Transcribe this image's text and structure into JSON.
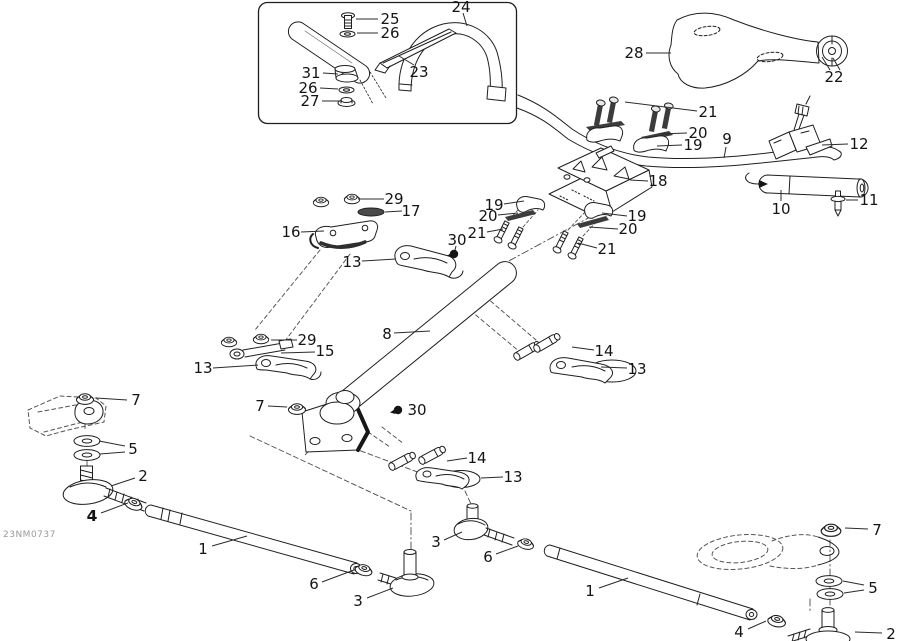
{
  "figure": {
    "code": "23NM0737"
  },
  "colors": {
    "line": "#1f1f1f",
    "dark_fill": "#3c3c3c",
    "leader": "#2b2b2b",
    "code_text": "#9a9a9a"
  },
  "labels": [
    {
      "text": "25",
      "x": 390,
      "y": 19,
      "lines": [
        [
          378,
          19,
          356,
          19
        ]
      ]
    },
    {
      "text": "26",
      "x": 390,
      "y": 33,
      "lines": [
        [
          378,
          33,
          357,
          33
        ]
      ]
    },
    {
      "text": "31",
      "x": 311,
      "y": 73,
      "lines": [
        [
          323,
          73,
          338,
          74
        ]
      ]
    },
    {
      "text": "26",
      "x": 308,
      "y": 88,
      "lines": [
        [
          320,
          88,
          338,
          89
        ]
      ]
    },
    {
      "text": "27",
      "x": 310,
      "y": 101,
      "lines": [
        [
          322,
          101,
          340,
          101
        ]
      ]
    },
    {
      "text": "23",
      "x": 419,
      "y": 72,
      "lines": [
        [
          414,
          65,
          399,
          56
        ]
      ]
    },
    {
      "text": "24",
      "x": 461,
      "y": 7,
      "lines": [
        [
          463,
          13,
          467,
          26
        ]
      ]
    },
    {
      "text": "28",
      "x": 634,
      "y": 53,
      "lines": [
        [
          646,
          53,
          671,
          53
        ]
      ]
    },
    {
      "text": "22",
      "x": 834,
      "y": 77,
      "lines": [
        [
          830,
          70,
          822,
          57
        ],
        [
          840,
          70,
          833,
          58
        ]
      ]
    },
    {
      "text": "21",
      "x": 708,
      "y": 112,
      "lines": [
        [
          697,
          111,
          625,
          102
        ]
      ]
    },
    {
      "text": "20",
      "x": 698,
      "y": 133,
      "lines": [
        [
          687,
          133,
          660,
          134
        ]
      ]
    },
    {
      "text": "19",
      "x": 693,
      "y": 145,
      "lines": [
        [
          682,
          145,
          657,
          146
        ]
      ]
    },
    {
      "text": "9",
      "x": 727,
      "y": 139,
      "lines": [
        [
          726,
          147,
          724,
          158
        ]
      ]
    },
    {
      "text": "12",
      "x": 859,
      "y": 144,
      "lines": [
        [
          848,
          144,
          822,
          145
        ]
      ]
    },
    {
      "text": "10",
      "x": 781,
      "y": 209,
      "lines": [
        [
          781,
          201,
          781,
          190
        ]
      ]
    },
    {
      "text": "11",
      "x": 869,
      "y": 200,
      "lines": [
        [
          858,
          200,
          846,
          200
        ]
      ]
    },
    {
      "text": "18",
      "x": 658,
      "y": 181,
      "lines": [
        [
          648,
          181,
          630,
          180
        ]
      ]
    },
    {
      "text": "19",
      "x": 494,
      "y": 205,
      "lines": [
        [
          504,
          204,
          524,
          201
        ]
      ]
    },
    {
      "text": "20",
      "x": 488,
      "y": 216,
      "lines": [
        [
          498,
          215,
          518,
          213
        ]
      ]
    },
    {
      "text": "21",
      "x": 477,
      "y": 233,
      "lines": [
        [
          487,
          232,
          503,
          229
        ]
      ]
    },
    {
      "text": "30",
      "x": 457,
      "y": 240,
      "lines": [
        [
          456,
          246,
          455,
          250
        ]
      ]
    },
    {
      "text": "19",
      "x": 637,
      "y": 216,
      "lines": [
        [
          627,
          216,
          602,
          213
        ]
      ]
    },
    {
      "text": "20",
      "x": 628,
      "y": 229,
      "lines": [
        [
          618,
          229,
          589,
          227
        ]
      ]
    },
    {
      "text": "21",
      "x": 607,
      "y": 249,
      "lines": [
        [
          597,
          248,
          578,
          243
        ]
      ]
    },
    {
      "text": "29",
      "x": 394,
      "y": 199,
      "lines": [
        [
          384,
          199,
          358,
          199
        ]
      ]
    },
    {
      "text": "17",
      "x": 411,
      "y": 211,
      "lines": [
        [
          402,
          211,
          385,
          212
        ]
      ]
    },
    {
      "text": "16",
      "x": 291,
      "y": 232,
      "lines": [
        [
          301,
          232,
          324,
          231
        ]
      ]
    },
    {
      "text": "13",
      "x": 352,
      "y": 262,
      "lines": [
        [
          362,
          261,
          396,
          259
        ]
      ]
    },
    {
      "text": "8",
      "x": 387,
      "y": 334,
      "lines": [
        [
          394,
          333,
          430,
          331
        ]
      ]
    },
    {
      "text": "29",
      "x": 307,
      "y": 340,
      "lines": [
        [
          297,
          340,
          271,
          340
        ]
      ]
    },
    {
      "text": "15",
      "x": 325,
      "y": 351,
      "lines": [
        [
          315,
          352,
          281,
          353
        ]
      ]
    },
    {
      "text": "13",
      "x": 203,
      "y": 368,
      "lines": [
        [
          213,
          368,
          258,
          365
        ]
      ]
    },
    {
      "text": "14",
      "x": 604,
      "y": 351,
      "lines": [
        [
          594,
          350,
          572,
          347
        ]
      ]
    },
    {
      "text": "13",
      "x": 637,
      "y": 369,
      "lines": [
        [
          627,
          368,
          601,
          367
        ]
      ]
    },
    {
      "text": "7",
      "x": 260,
      "y": 406,
      "lines": [
        [
          268,
          406,
          287,
          407
        ]
      ]
    },
    {
      "text": "30",
      "x": 417,
      "y": 410,
      "lines": []
    },
    {
      "text": "14",
      "x": 477,
      "y": 458,
      "lines": [
        [
          467,
          458,
          447,
          461
        ]
      ]
    },
    {
      "text": "13",
      "x": 513,
      "y": 477,
      "lines": [
        [
          503,
          477,
          481,
          478
        ]
      ]
    },
    {
      "text": "7",
      "x": 136,
      "y": 400,
      "lines": [
        [
          127,
          400,
          96,
          398
        ]
      ]
    },
    {
      "text": "5",
      "x": 133,
      "y": 449,
      "lines": [
        [
          125,
          446,
          99,
          441
        ],
        [
          125,
          452,
          100,
          454
        ]
      ]
    },
    {
      "text": "2",
      "x": 143,
      "y": 476,
      "lines": [
        [
          135,
          478,
          111,
          486
        ]
      ]
    },
    {
      "text": "4",
      "x": 92,
      "y": 516,
      "bold": true,
      "lines": [
        [
          101,
          513,
          128,
          503
        ]
      ]
    },
    {
      "text": "1",
      "x": 203,
      "y": 549,
      "lines": [
        [
          212,
          546,
          247,
          536
        ]
      ]
    },
    {
      "text": "6",
      "x": 314,
      "y": 584,
      "lines": [
        [
          322,
          582,
          354,
          570
        ]
      ]
    },
    {
      "text": "3",
      "x": 358,
      "y": 601,
      "lines": [
        [
          367,
          598,
          393,
          588
        ]
      ]
    },
    {
      "text": "3",
      "x": 436,
      "y": 542,
      "lines": [
        [
          444,
          540,
          462,
          532
        ]
      ]
    },
    {
      "text": "6",
      "x": 488,
      "y": 557,
      "lines": [
        [
          496,
          554,
          518,
          546
        ]
      ]
    },
    {
      "text": "1",
      "x": 590,
      "y": 591,
      "lines": [
        [
          599,
          588,
          628,
          578
        ]
      ]
    },
    {
      "text": "7",
      "x": 877,
      "y": 530,
      "lines": [
        [
          868,
          529,
          845,
          528
        ]
      ]
    },
    {
      "text": "5",
      "x": 873,
      "y": 588,
      "lines": [
        [
          864,
          585,
          843,
          581
        ],
        [
          864,
          590,
          844,
          593
        ]
      ]
    },
    {
      "text": "4",
      "x": 739,
      "y": 632,
      "lines": [
        [
          748,
          629,
          766,
          621
        ]
      ]
    },
    {
      "text": "2",
      "x": 891,
      "y": 634,
      "lines": [
        [
          882,
          633,
          855,
          632
        ]
      ]
    }
  ]
}
